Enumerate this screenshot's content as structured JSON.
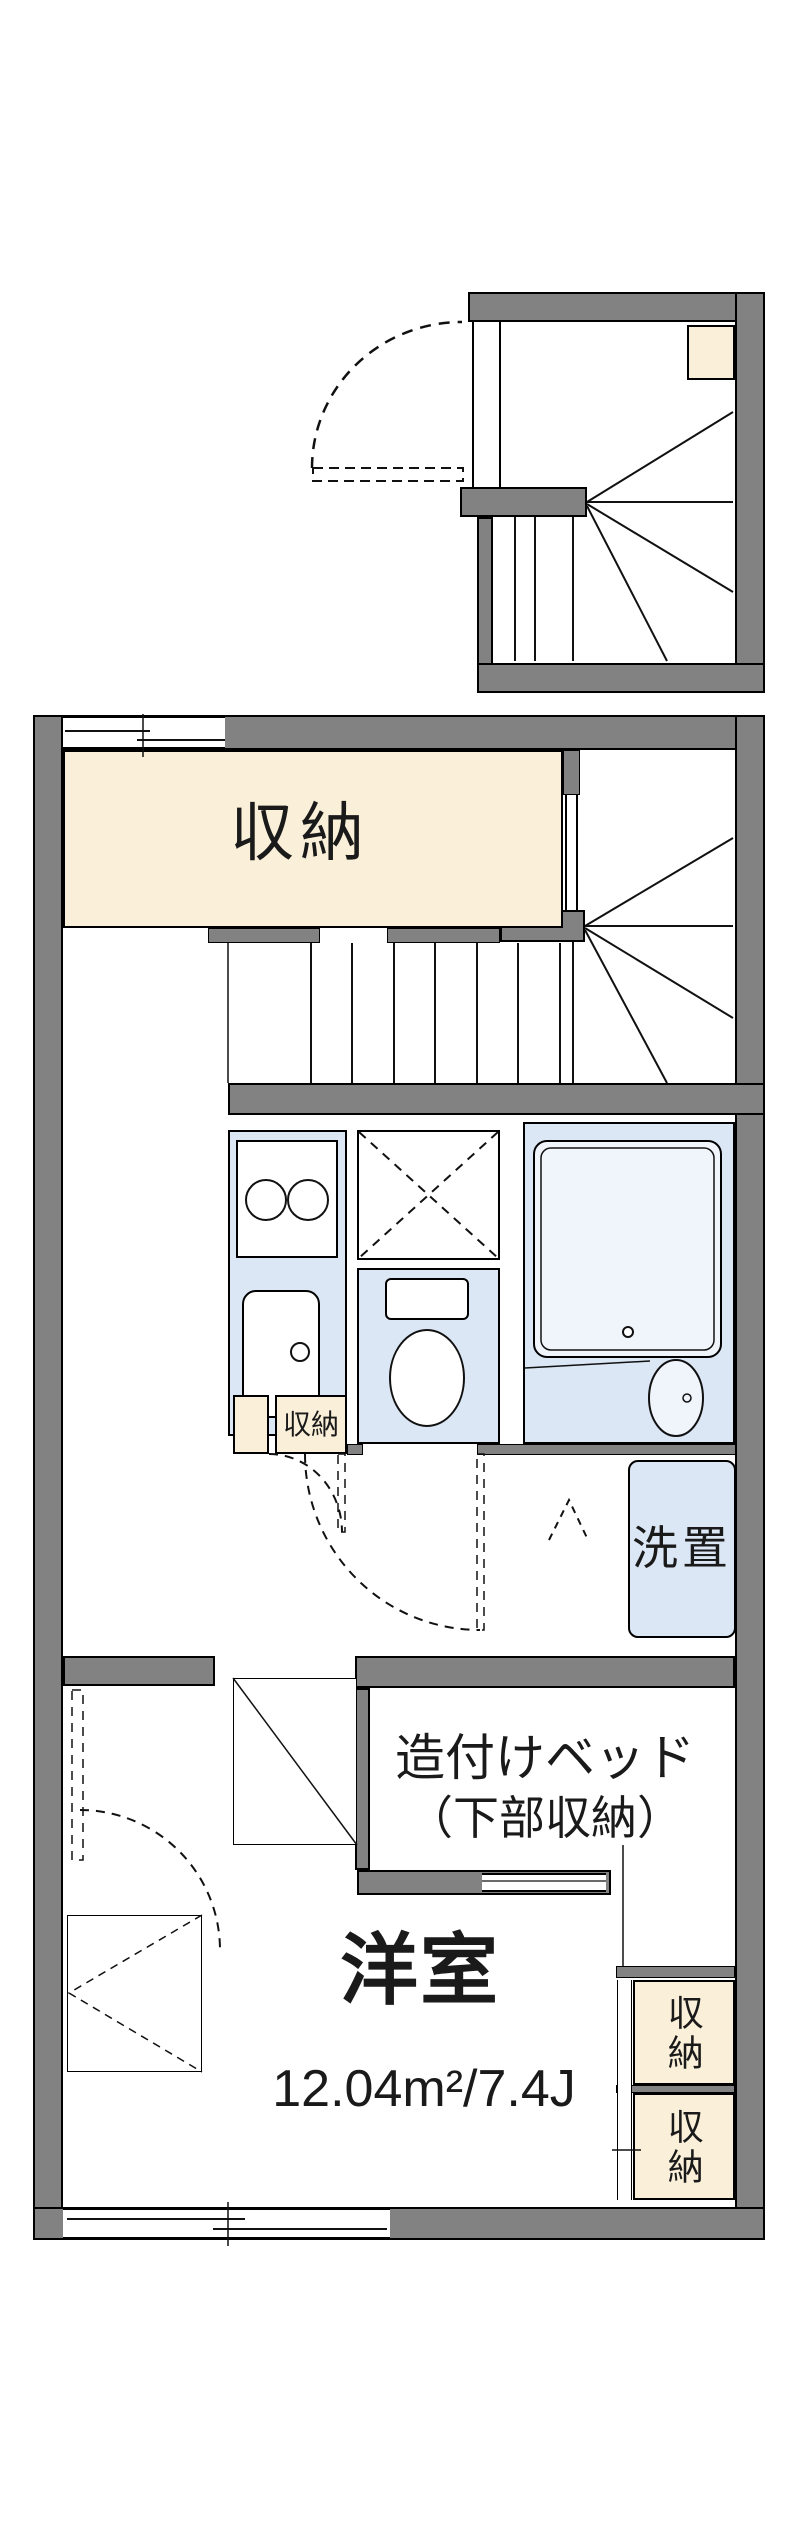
{
  "plan": {
    "colors": {
      "wall_gray": "#828282",
      "floor_cream": "#FAEFD8",
      "floor_blue": "#DCE7F5",
      "line_black": "#111111"
    },
    "labels": {
      "storage_room": "収納",
      "storage_small": "収納",
      "wash_place": "洗置",
      "built_in_bed_line1": "造付けベッド",
      "built_in_bed_line2": "（下部収納）",
      "room_title": "洋室",
      "room_area": "12.04m²/7.4J",
      "closet_right_top": "収納",
      "closet_right_bottom": "収納"
    }
  }
}
